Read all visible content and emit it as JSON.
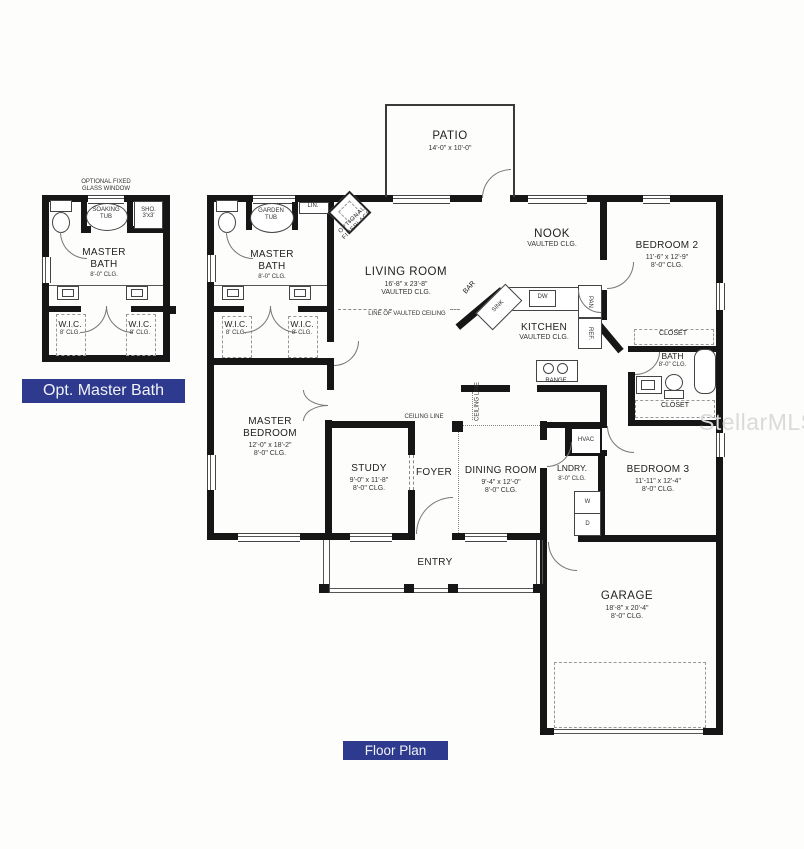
{
  "captions": {
    "inset_title": "Opt. Master Bath",
    "plan_title": "Floor Plan"
  },
  "watermark": {
    "text": "StellarMLS"
  },
  "colors": {
    "caption_bg": "#2d3a8e",
    "wall": "#161616",
    "watermark": "#dadada"
  },
  "inset": {
    "window_note1": "OPTIONAL FIXED",
    "window_note2": "GLASS WINDOW",
    "tub1": "SOAKING",
    "tub2": "TUB",
    "shower1": "SHO.",
    "shower2": "3'x3'",
    "bath_name1": "MASTER",
    "bath_name2": "BATH",
    "bath_clg": "8'-0\" CLG.",
    "wic_left": {
      "name": "W.I.C.",
      "clg": "8' CLG."
    },
    "wic_right": {
      "name": "W.I.C.",
      "clg": "8' CLG."
    }
  },
  "main": {
    "patio": {
      "name": "PATIO",
      "dims": "14'-0\" x 10'-0\""
    },
    "living": {
      "name": "LIVING ROOM",
      "dims": "16'-8\" x 23'-8\"",
      "clg": "VAULTED CLG.",
      "ceiling_note": "LINE OF VAULTED CEILING"
    },
    "nook": {
      "name": "NOOK",
      "clg": "VAULTED CLG."
    },
    "kitchen": {
      "name": "KITCHEN",
      "clg": "VAULTED CLG.",
      "bar": "BAR",
      "sink": "SINK",
      "dw": "DW",
      "pan": "PAN",
      "ref": "REF.",
      "range": "RANGE"
    },
    "fireplace": {
      "line1": "OPTIONAL",
      "line2": "FIREPLACE"
    },
    "master_bath": {
      "name1": "MASTER",
      "name2": "BATH",
      "clg": "8'-0\" CLG.",
      "tub1": "GARDEN",
      "tub2": "TUB",
      "linen": "LIN."
    },
    "wic_left": {
      "name": "W.I.C.",
      "clg": "8' CLG."
    },
    "wic_right": {
      "name": "W.I.C.",
      "clg": "8' CLG."
    },
    "master_bedroom": {
      "name1": "MASTER",
      "name2": "BEDROOM",
      "dims": "12'-0\" x 18'-2\"",
      "clg": "8'-0\" CLG."
    },
    "study": {
      "name": "STUDY",
      "dims": "9'-0\" x 11'-8\"",
      "clg": "8'-0\" CLG."
    },
    "foyer": {
      "name": "FOYER"
    },
    "dining": {
      "name": "DINING ROOM",
      "dims": "9'-4\" x 12'-0\"",
      "clg": "8'-0\" CLG."
    },
    "ceiling_line_h": "CEILING LINE",
    "ceiling_line_v": "CEILING LINE",
    "bedroom2": {
      "name": "BEDROOM 2",
      "dims": "11'-6\" x 12'-9\"",
      "clg": "8'-0\" CLG."
    },
    "closet_top": "CLOSET",
    "closet_bottom": "CLOSET",
    "bath": {
      "name": "BATH",
      "clg": "8'-0\" CLG."
    },
    "hvac": "HVAC",
    "laundry": {
      "name": "LNDRY.",
      "clg": "8'-0\" CLG."
    },
    "washer": "W",
    "dryer": "D",
    "bedroom3": {
      "name": "BEDROOM 3",
      "dims": "11'-11\" x 12'-4\"",
      "clg": "8'-0\" CLG."
    },
    "entry": {
      "name": "ENTRY"
    },
    "garage": {
      "name": "GARAGE",
      "dims": "18'-8\" x 20'-4\"",
      "clg": "8'-0\" CLG."
    }
  }
}
